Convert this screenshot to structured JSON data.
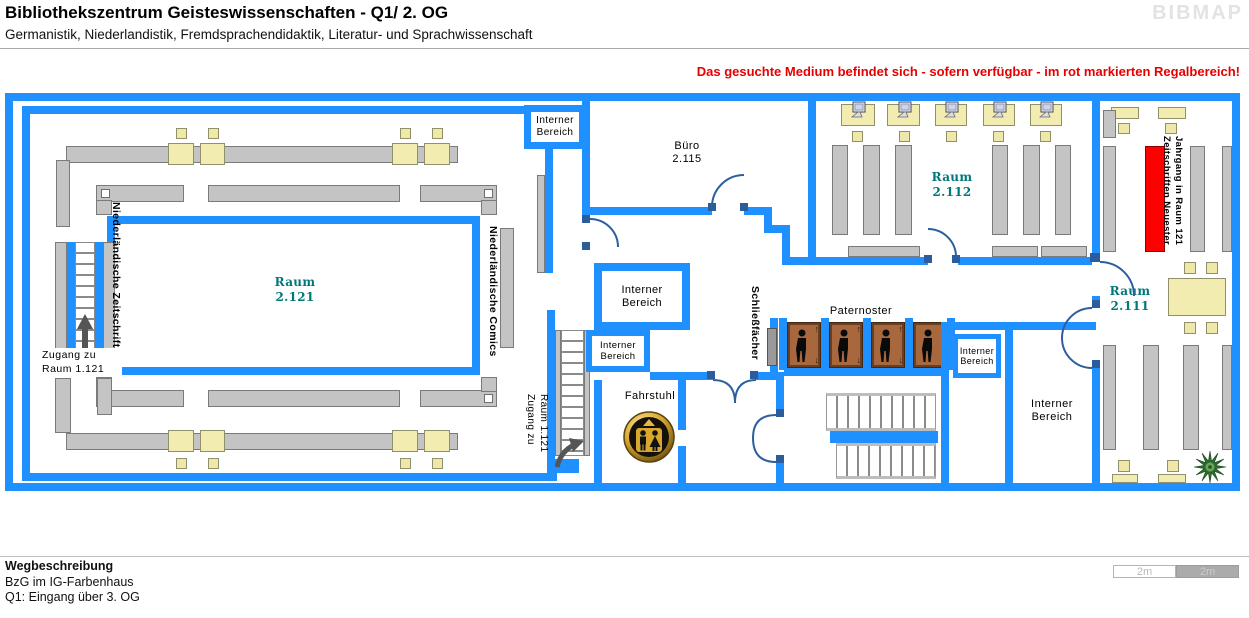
{
  "header": {
    "title": "Bibliothekszentrum Geisteswissenschaften - Q1/ 2. OG",
    "subtitle": "Germanistik, Niederlandistik, Fremdsprachendidaktik, Literatur- und Sprachwissenschaft",
    "logo": "BIBMAP"
  },
  "notice": "Das gesuchte Medium befindet sich - sofern verfügbar -  im rot markierten Regalbereich!",
  "rooms": {
    "r2121": {
      "name": "Raum",
      "number": "2.121"
    },
    "r2112": {
      "name": "Raum",
      "number": "2.112"
    },
    "r2111": {
      "name": "Raum",
      "number": "2.111"
    },
    "buero": {
      "name": "Büro",
      "number": "2.115"
    }
  },
  "labels": {
    "ib1": "Interner",
    "ib2": "Bereich",
    "fahrstuhl": "Fahrstuhl",
    "paternoster": "Paternoster",
    "schliessfaecher": "Schließfächer",
    "ndl_zeitschriften": "Niederländische Zeitschriften",
    "ndl_comics": "Niederländische Comics",
    "marker_line1": "Zeitschriften Neuester",
    "marker_line2": "Jahrgang in Raum 121",
    "zugang_line1": "Zugang zu",
    "zugang_line2": "Raum 1.121"
  },
  "footer": {
    "heading": "Wegbeschreibung",
    "line1": "BzG im IG-Farbenhaus",
    "line2": "Q1: Eingang über 3. OG"
  },
  "scalebar": {
    "left": "2m",
    "right": "2m"
  },
  "colors": {
    "wall": "#1e90ff",
    "highlight_shelf": "#ff0000",
    "room_label": "#00787a",
    "notice_text": "#e80000",
    "shelf": "#c4c4c4",
    "desk": "#f2ecb0",
    "paternoster_cabin": "#a8673c"
  }
}
